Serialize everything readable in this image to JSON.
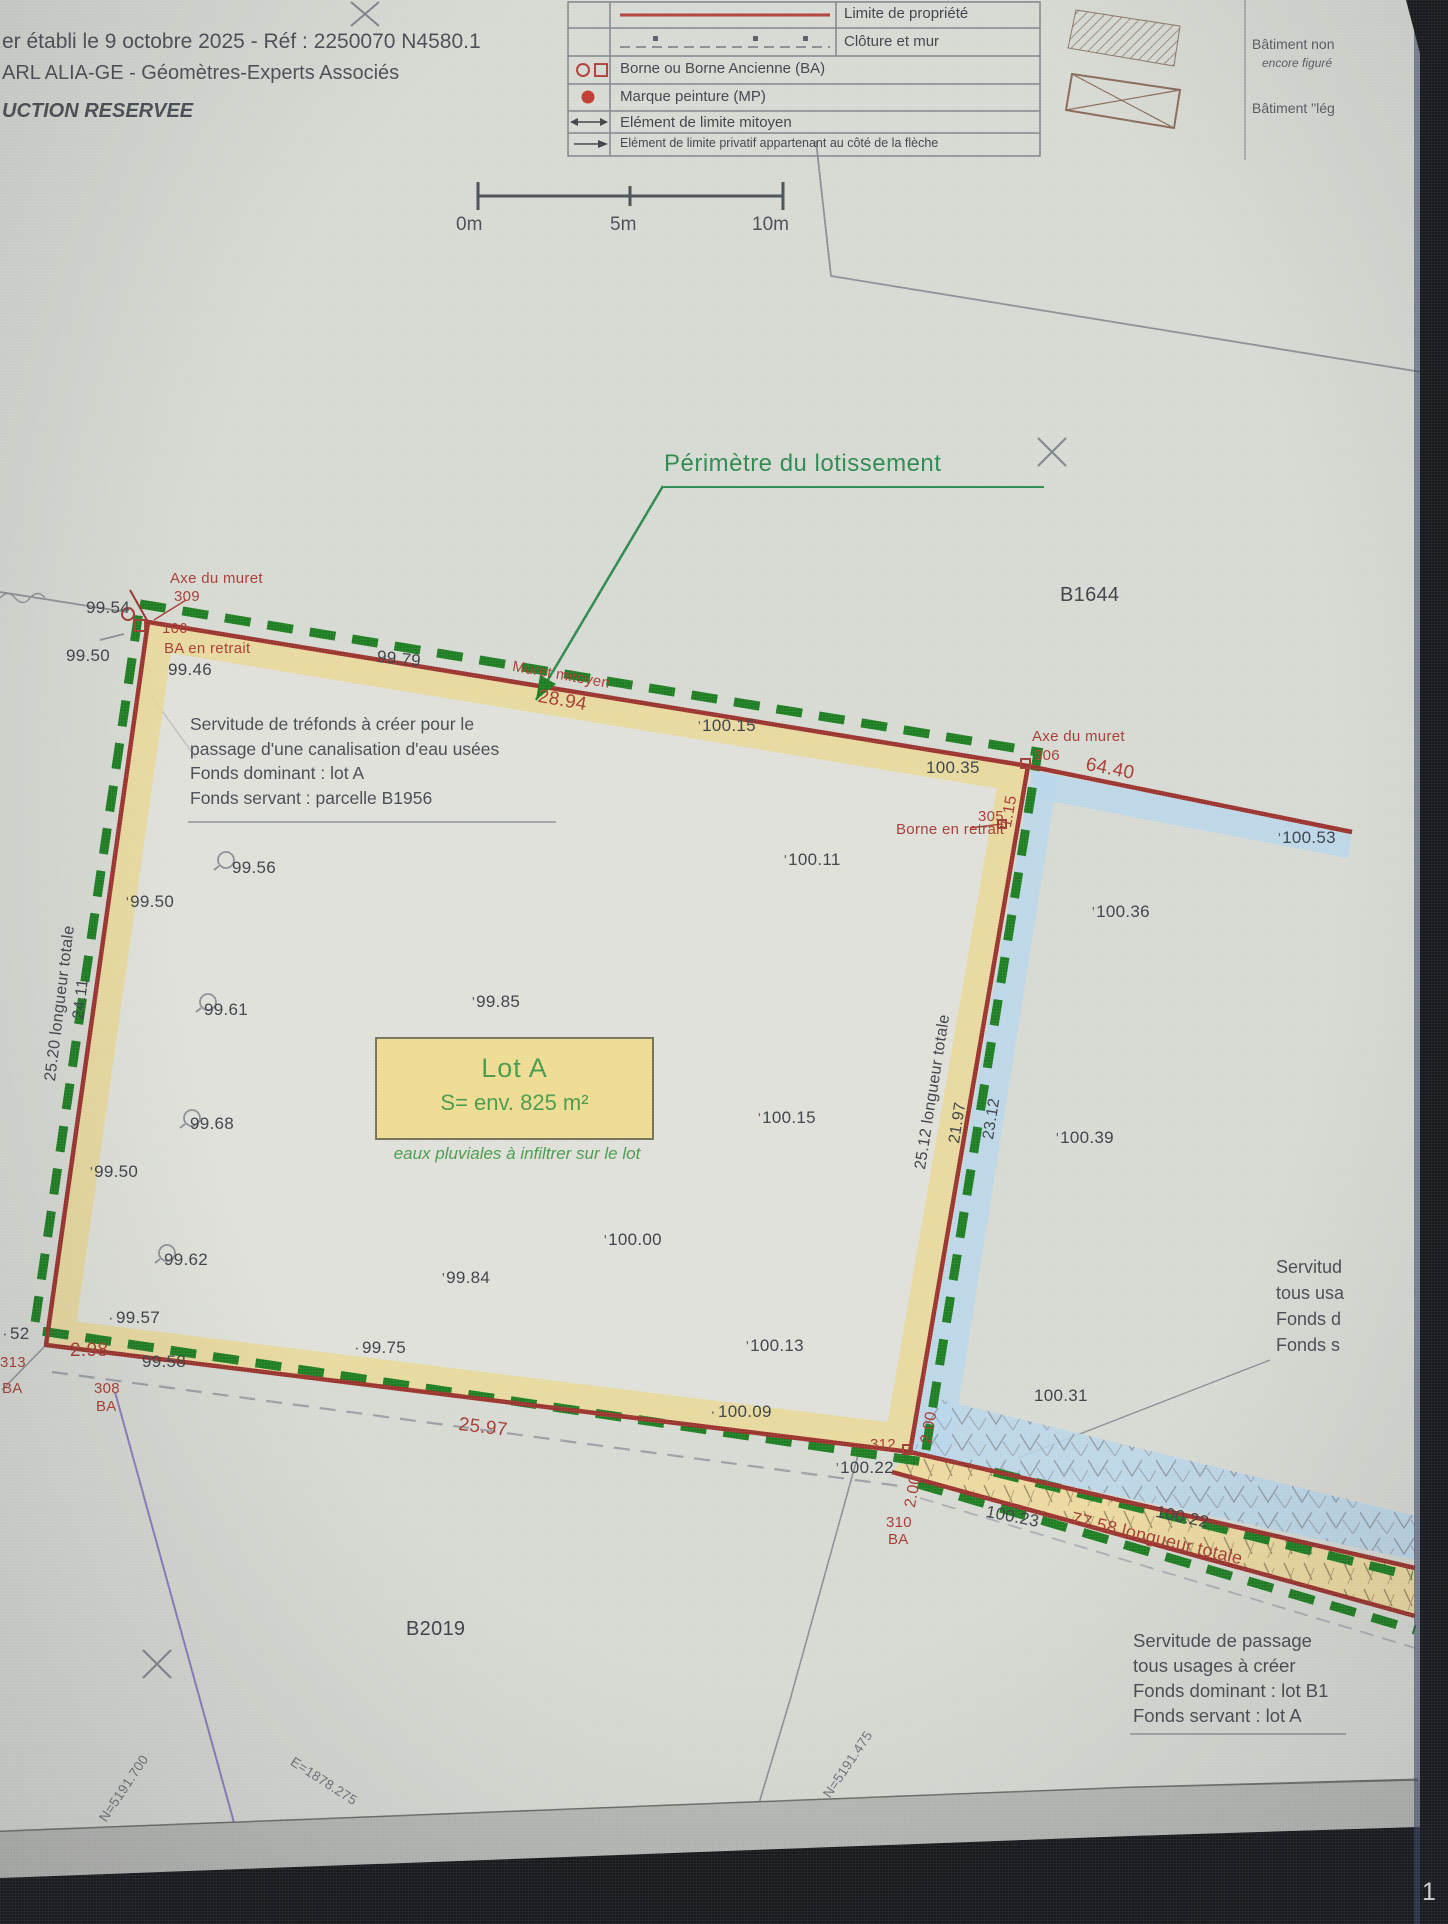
{
  "page": {
    "sheet_number": "1"
  },
  "header": {
    "line1": "er établi le 9 octobre 2025 - Réf : 2250070 N4580.1",
    "line2": "ARL ALIA-GE - Géomètres-Experts Associés",
    "line3": "UCTION RESERVEE"
  },
  "legend": {
    "rows": [
      {
        "symbol": "red-solid-line",
        "label": "Limite de propriété"
      },
      {
        "symbol": "fence-dashed-line",
        "label": "Clôture et mur"
      },
      {
        "symbol": "circle-and-square",
        "label": "Borne ou Borne Ancienne (BA)"
      },
      {
        "symbol": "red-dot",
        "label": "Marque peinture (MP)"
      },
      {
        "symbol": "double-arrow",
        "label": "Elément de limite mitoyen"
      },
      {
        "symbol": "right-arrow",
        "label": "Elément de limite privatif appartenant au côté de la flèche"
      }
    ],
    "buildings": {
      "b1_line1": "Bâtiment non",
      "b1_line2": "encore figuré",
      "b2_line1": "Bâtiment \"lég"
    }
  },
  "scalebar": {
    "t0": "0m",
    "t5": "5m",
    "t10": "10m"
  },
  "annotations": {
    "perimeter": "Périmètre du lotissement"
  },
  "lot_a": {
    "title": "Lot A",
    "area": "S= env. 825 m²",
    "note": "eaux pluviales à infiltrer sur le lot"
  },
  "servitude_trefonds": {
    "l1": "Servitude de tréfonds à créer pour le",
    "l2": "passage d'une canalisation d'eau usées",
    "l3": "Fonds dominant : lot A",
    "l4": "Fonds servant : parcelle B1956"
  },
  "servitude_passage": {
    "l1": "Servitude de passage",
    "l2": "tous usages à créer",
    "l3": "Fonds dominant : lot B1",
    "l4": "Fonds servant : lot A"
  },
  "servitude_partial": {
    "l1": "Servitud",
    "l2": "tous usa",
    "l3": "Fonds d",
    "l4": "Fonds s"
  },
  "colors": {
    "boundary_red": "#9b332e",
    "perimeter_green": "#1e7e22",
    "band_yellow": "#ead794",
    "band_blue": "#b9d6ea",
    "annotation_red": "#a63d34",
    "lot_green": "#4a9a4e"
  },
  "plan_labels": [
    {
      "kind": "elevation",
      "t": "99.54",
      "x": 86,
      "y": 598
    },
    {
      "kind": "elevation",
      "t": "99.50",
      "x": 66,
      "y": 646
    },
    {
      "kind": "elevation",
      "t": "99.46",
      "x": 168,
      "y": 660
    },
    {
      "kind": "elevation",
      "t": "99.79",
      "x": 378,
      "y": 647,
      "r": 6
    },
    {
      "kind": "elevation",
      "t": "100.15",
      "x": 698,
      "y": 716,
      "m": "t"
    },
    {
      "kind": "elevation",
      "t": "100.35",
      "x": 926,
      "y": 758
    },
    {
      "kind": "elevation",
      "t": "100.53",
      "x": 1278,
      "y": 828,
      "m": "t"
    },
    {
      "kind": "elevation",
      "t": "100.11",
      "x": 784,
      "y": 850,
      "m": "t"
    },
    {
      "kind": "elevation",
      "t": "100.36",
      "x": 1092,
      "y": 902,
      "m": "t"
    },
    {
      "kind": "elevation",
      "t": "99.56",
      "x": 232,
      "y": 858
    },
    {
      "kind": "elevation",
      "t": "99.50",
      "x": 126,
      "y": 892,
      "m": "t"
    },
    {
      "kind": "elevation",
      "t": "99.61",
      "x": 204,
      "y": 1000
    },
    {
      "kind": "elevation",
      "t": "99.85",
      "x": 472,
      "y": 992,
      "m": "t"
    },
    {
      "kind": "elevation",
      "t": "99.68",
      "x": 190,
      "y": 1114
    },
    {
      "kind": "elevation",
      "t": "100.15",
      "x": 758,
      "y": 1108,
      "m": "t"
    },
    {
      "kind": "elevation",
      "t": "100.39",
      "x": 1056,
      "y": 1128,
      "m": "t"
    },
    {
      "kind": "elevation",
      "t": "99.50",
      "x": 90,
      "y": 1162,
      "m": "t"
    },
    {
      "kind": "elevation",
      "t": "100.00",
      "x": 604,
      "y": 1230,
      "m": "t"
    },
    {
      "kind": "elevation",
      "t": "99.62",
      "x": 164,
      "y": 1250
    },
    {
      "kind": "elevation",
      "t": "99.84",
      "x": 442,
      "y": 1268,
      "m": "t"
    },
    {
      "kind": "elevation",
      "t": "99.57",
      "x": 108,
      "y": 1308,
      "m": "d"
    },
    {
      "kind": "elevation",
      "t": "100.13",
      "x": 746,
      "y": 1336,
      "m": "t"
    },
    {
      "kind": "elevation",
      "t": "99.75",
      "x": 354,
      "y": 1338,
      "m": "d"
    },
    {
      "kind": "elevation",
      "t": "99.58",
      "x": 142,
      "y": 1352
    },
    {
      "kind": "elevation",
      "t": "100.09",
      "x": 710,
      "y": 1402,
      "m": "d"
    },
    {
      "kind": "elevation",
      "t": "100.31",
      "x": 1034,
      "y": 1386
    },
    {
      "kind": "elevation",
      "t": "100.22",
      "x": 836,
      "y": 1458,
      "m": "t"
    },
    {
      "kind": "elevation",
      "t": "100.23",
      "x": 988,
      "y": 1502,
      "r": 11
    },
    {
      "kind": "elevation",
      "t": "100.22",
      "x": 1158,
      "y": 1502,
      "r": 12
    },
    {
      "kind": "elevation",
      "t": "52",
      "x": 2,
      "y": 1324,
      "m": "d"
    },
    {
      "kind": "boundary-annotation",
      "t": "Axe du muret",
      "x": 170,
      "y": 570,
      "c": "r",
      "fs": 15
    },
    {
      "kind": "point-number",
      "t": "309",
      "x": 174,
      "y": 588,
      "c": "r",
      "fs": 15
    },
    {
      "kind": "point-number",
      "t": "100",
      "x": 162,
      "y": 620,
      "c": "r",
      "fs": 15
    },
    {
      "kind": "boundary-annotation",
      "t": "BA en retrait",
      "x": 164,
      "y": 640,
      "c": "r",
      "fs": 15
    },
    {
      "kind": "boundary-annotation",
      "t": "Muret mitoyen",
      "x": 514,
      "y": 658,
      "c": "r",
      "r": 10,
      "fs": 15
    },
    {
      "kind": "dimension",
      "t": "28.94",
      "x": 540,
      "y": 686,
      "c": "r",
      "r": 10,
      "fs": 19
    },
    {
      "kind": "boundary-annotation",
      "t": "Axe du muret",
      "x": 1032,
      "y": 728,
      "c": "r",
      "fs": 15
    },
    {
      "kind": "point-number",
      "t": "306",
      "x": 1034,
      "y": 747,
      "c": "r",
      "fs": 15
    },
    {
      "kind": "dimension",
      "t": "64.40",
      "x": 1088,
      "y": 754,
      "c": "r",
      "r": 11,
      "fs": 19
    },
    {
      "kind": "dimension",
      "t": "1.15",
      "x": 998,
      "y": 826,
      "c": "r",
      "r": -80,
      "fs": 16
    },
    {
      "kind": "point-number",
      "t": "305",
      "x": 978,
      "y": 808,
      "c": "r",
      "fs": 15
    },
    {
      "kind": "boundary-annotation",
      "t": "Borne en retrait",
      "x": 896,
      "y": 821,
      "c": "r",
      "fs": 15
    },
    {
      "kind": "dimension",
      "t": "2.98",
      "x": 70,
      "y": 1340,
      "c": "r",
      "fs": 19
    },
    {
      "kind": "point-number",
      "t": "313",
      "x": 0,
      "y": 1354,
      "c": "r",
      "fs": 15
    },
    {
      "kind": "point-number",
      "t": "BA",
      "x": 2,
      "y": 1380,
      "c": "r",
      "fs": 15
    },
    {
      "kind": "point-number",
      "t": "308",
      "x": 94,
      "y": 1380,
      "c": "r",
      "fs": 15
    },
    {
      "kind": "point-number",
      "t": "BA",
      "x": 96,
      "y": 1398,
      "c": "r",
      "fs": 15
    },
    {
      "kind": "point-number",
      "t": "312",
      "x": 870,
      "y": 1436,
      "c": "r",
      "fs": 15
    },
    {
      "kind": "dimension",
      "t": "2.00",
      "x": 918,
      "y": 1442,
      "c": "r",
      "r": -80,
      "fs": 16
    },
    {
      "kind": "dimension",
      "t": "2.00",
      "x": 902,
      "y": 1506,
      "c": "r",
      "r": -80,
      "fs": 16
    },
    {
      "kind": "point-number",
      "t": "310",
      "x": 886,
      "y": 1514,
      "c": "r",
      "fs": 15
    },
    {
      "kind": "point-number",
      "t": "BA",
      "x": 888,
      "y": 1531,
      "c": "r",
      "fs": 15
    },
    {
      "kind": "dimension",
      "t": "25.97",
      "x": 460,
      "y": 1414,
      "c": "r",
      "r": 7,
      "fs": 19
    },
    {
      "kind": "dimension",
      "t": "77.58 longueur totale",
      "x": 1074,
      "y": 1508,
      "c": "r",
      "r": 13.5,
      "fs": 18
    },
    {
      "kind": "dimension",
      "t": "25.20 longueur totale",
      "x": 42,
      "y": 1080,
      "r": -83,
      "fs": 16
    },
    {
      "kind": "dimension",
      "t": "24.11",
      "x": 70,
      "y": 1018,
      "r": -83,
      "fs": 16
    },
    {
      "kind": "dimension",
      "t": "25.12 longueur totale",
      "x": 912,
      "y": 1168,
      "r": -81,
      "fs": 16
    },
    {
      "kind": "dimension",
      "t": "21.97",
      "x": 946,
      "y": 1142,
      "r": -81,
      "fs": 16
    },
    {
      "kind": "dimension",
      "t": "23.12",
      "x": 980,
      "y": 1138,
      "r": -81,
      "fs": 16
    },
    {
      "kind": "coordinate",
      "t": "N=5191.700",
      "x": 96,
      "y": 1816,
      "r": -56,
      "c": "gy",
      "fs": 13.5
    },
    {
      "kind": "coordinate",
      "t": "E=1878.275",
      "x": 296,
      "y": 1754,
      "r": 33,
      "c": "gy",
      "fs": 13.5
    },
    {
      "kind": "coordinate",
      "t": "N=5191.475",
      "x": 820,
      "y": 1792,
      "r": -56,
      "c": "gy",
      "fs": 13.5
    },
    {
      "kind": "parcel-label",
      "t": "B1644",
      "x": 1060,
      "y": 584,
      "fs": 20
    },
    {
      "kind": "parcel-label",
      "t": "B2019",
      "x": 406,
      "y": 1618,
      "fs": 20
    }
  ]
}
